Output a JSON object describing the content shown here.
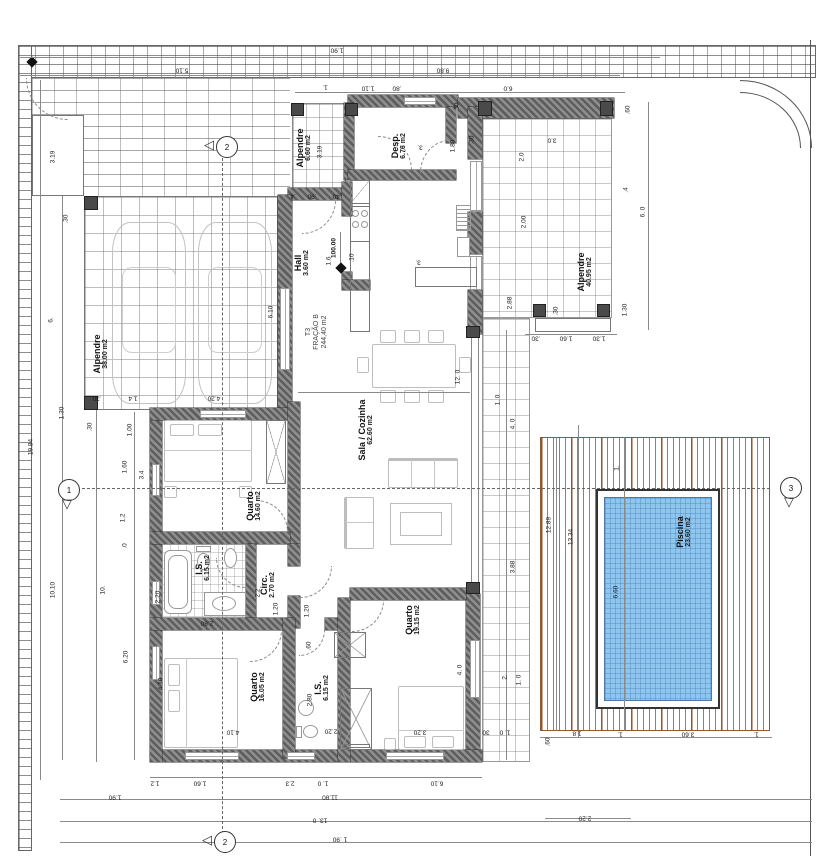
{
  "colors": {
    "wall_hatch": "#5e5e5e",
    "deck_stripe": "#a0522d",
    "pool_water": "#8ec6ee",
    "line": "#555",
    "brick_line": "#5f5f5f"
  },
  "plan": {
    "rooms": [
      {
        "lines": [
          "Alpendre",
          "38.00 m2"
        ],
        "x": 101,
        "y": 354,
        "style": "room"
      },
      {
        "lines": [
          "Alpendre",
          "6.60 m2"
        ],
        "x": 304,
        "y": 148,
        "style": "room"
      },
      {
        "lines": [
          "Hall",
          "3.60 m2"
        ],
        "x": 302,
        "y": 263,
        "style": "room"
      },
      {
        "lines": [
          "Desp.",
          "6.76 m2"
        ],
        "x": 399,
        "y": 146,
        "style": "room"
      },
      {
        "lines": [
          "T3",
          "FRAÇÃO B",
          "244,40 m2"
        ],
        "x": 317,
        "y": 332,
        "style": "unit"
      },
      {
        "lines": [
          "Sala / Cozinha",
          "62.60 m2"
        ],
        "x": 366,
        "y": 430,
        "style": "room"
      },
      {
        "lines": [
          "Quarto",
          "14.60 m2"
        ],
        "x": 254,
        "y": 506,
        "style": "room"
      },
      {
        "lines": [
          "I.S.",
          "6.15 m2"
        ],
        "x": 203,
        "y": 568,
        "style": "room"
      },
      {
        "lines": [
          "Circ.",
          "2.70 m2"
        ],
        "x": 268,
        "y": 585,
        "style": "room"
      },
      {
        "lines": [
          "Quarto",
          "16.05 m2"
        ],
        "x": 258,
        "y": 687,
        "style": "room"
      },
      {
        "lines": [
          "I.S.",
          "6.15 m2"
        ],
        "x": 322,
        "y": 688,
        "style": "room"
      },
      {
        "lines": [
          "Quarto",
          "19.15 m2"
        ],
        "x": 413,
        "y": 620,
        "style": "room"
      },
      {
        "lines": [
          "Alpendre",
          "40.95 m2"
        ],
        "x": 585,
        "y": 272,
        "style": "room"
      },
      {
        "lines": [
          "Piscina",
          "23.60 m2"
        ],
        "x": 684,
        "y": 532,
        "style": "room"
      }
    ],
    "dims": [
      {
        "t": "1.90",
        "x": 337,
        "y": 50,
        "r": 180
      },
      {
        "t": "5.10",
        "x": 182,
        "y": 70,
        "r": 180
      },
      {
        "t": "9.80",
        "x": 443,
        "y": 70,
        "r": 180
      },
      {
        "t": "6.0",
        "x": 508,
        "y": 88,
        "r": 180
      },
      {
        "t": "1.",
        "x": 325,
        "y": 87,
        "r": 180
      },
      {
        "t": "1.10",
        "x": 368,
        "y": 88,
        "r": 180
      },
      {
        "t": ".80",
        "x": 397,
        "y": 88,
        "r": 180
      },
      {
        "t": ".4",
        "x": 293,
        "y": 196,
        "r": 180
      },
      {
        "t": ".90",
        "x": 312,
        "y": 196,
        "r": 180
      },
      {
        "t": ".40",
        "x": 337,
        "y": 196,
        "r": 180
      },
      {
        "t": "3.0",
        "x": 552,
        "y": 140,
        "r": 180
      },
      {
        "t": "3.",
        "x": 420,
        "y": 147,
        "r": 180
      },
      {
        "t": "3.",
        "x": 418,
        "y": 262,
        "r": 180
      },
      {
        "t": ".60",
        "x": 628,
        "y": 110,
        "r": -90
      },
      {
        "t": ".30",
        "x": 457,
        "y": 107,
        "r": -90
      },
      {
        "t": ".30",
        "x": 472,
        "y": 140,
        "r": -90
      },
      {
        "t": "1.80",
        "x": 453,
        "y": 146,
        "r": -90
      },
      {
        "t": "2.0",
        "x": 522,
        "y": 157,
        "r": -90
      },
      {
        "t": "2.00",
        "x": 524,
        "y": 222,
        "r": -90
      },
      {
        "t": "2.88",
        "x": 510,
        "y": 303,
        "r": -90
      },
      {
        "t": ".4",
        "x": 626,
        "y": 190,
        "r": -90
      },
      {
        "t": "6. 0",
        "x": 643,
        "y": 212,
        "r": -90
      },
      {
        "t": "1.30",
        "x": 625,
        "y": 310,
        "r": -90
      },
      {
        "t": ".30",
        "x": 556,
        "y": 311,
        "r": -90
      },
      {
        "t": ".30",
        "x": 536,
        "y": 338,
        "r": 180
      },
      {
        "t": "1.60",
        "x": 566,
        "y": 338,
        "r": 180
      },
      {
        "t": "1.30",
        "x": 599,
        "y": 338,
        "r": 180
      },
      {
        "t": "19.84",
        "x": 31,
        "y": 447,
        "r": -90
      },
      {
        "t": "3.19",
        "x": 53,
        "y": 157,
        "r": -90
      },
      {
        "t": "6.",
        "x": 51,
        "y": 320,
        "r": -90
      },
      {
        "t": "10.10",
        "x": 53,
        "y": 590,
        "r": -90
      },
      {
        "t": ".30",
        "x": 66,
        "y": 219,
        "r": -90
      },
      {
        "t": "1.30",
        "x": 62,
        "y": 413,
        "r": -90
      },
      {
        "t": ".30",
        "x": 90,
        "y": 427,
        "r": -90
      },
      {
        "t": "1.00",
        "x": 130,
        "y": 430,
        "r": -90
      },
      {
        "t": "1.60",
        "x": 125,
        "y": 467,
        "r": -90
      },
      {
        "t": "10.",
        "x": 103,
        "y": 590,
        "r": -90
      },
      {
        "t": "6.20",
        "x": 126,
        "y": 657,
        "r": -90
      },
      {
        "t": "1.2",
        "x": 123,
        "y": 518,
        "r": -90
      },
      {
        "t": ".0",
        "x": 125,
        "y": 546,
        "r": -90
      },
      {
        "t": "4.20",
        "x": 214,
        "y": 398,
        "r": 180
      },
      {
        "t": "1.4",
        "x": 133,
        "y": 398,
        "r": 180
      },
      {
        "t": ".30",
        "x": 97,
        "y": 398,
        "r": 180
      },
      {
        "t": "6.10",
        "x": 271,
        "y": 312,
        "r": -90
      },
      {
        "t": "3.19",
        "x": 320,
        "y": 152,
        "r": -90
      },
      {
        "t": "1.6",
        "x": 329,
        "y": 261,
        "r": -90
      },
      {
        "t": ".10",
        "x": 352,
        "y": 258,
        "r": -90
      },
      {
        "t": "3.4",
        "x": 142,
        "y": 475,
        "r": -90
      },
      {
        "t": "2.20",
        "x": 158,
        "y": 597,
        "r": -90
      },
      {
        "t": "2.2",
        "x": 258,
        "y": 593,
        "r": -90
      },
      {
        "t": "2.80",
        "x": 207,
        "y": 623,
        "r": 180
      },
      {
        "t": "1.20",
        "x": 276,
        "y": 609,
        "r": -90
      },
      {
        "t": "1.20",
        "x": 307,
        "y": 611,
        "r": -90
      },
      {
        "t": ".60",
        "x": 309,
        "y": 646,
        "r": -90
      },
      {
        "t": "2.80",
        "x": 310,
        "y": 700,
        "r": -90
      },
      {
        "t": "2.20",
        "x": 331,
        "y": 731,
        "r": 180
      },
      {
        "t": "4.10",
        "x": 161,
        "y": 684,
        "r": -90
      },
      {
        "t": "4.10",
        "x": 233,
        "y": 732,
        "r": 180
      },
      {
        "t": "3.20",
        "x": 420,
        "y": 732,
        "r": 180
      },
      {
        "t": "4. 0",
        "x": 460,
        "y": 670,
        "r": -90
      },
      {
        "t": "12. 0",
        "x": 458,
        "y": 377,
        "r": -90
      },
      {
        "t": "1. 0",
        "x": 498,
        "y": 400,
        "r": -90
      },
      {
        "t": "4. 0",
        "x": 513,
        "y": 424,
        "r": -90
      },
      {
        "t": "3.88",
        "x": 513,
        "y": 567,
        "r": -90
      },
      {
        "t": "2.",
        "x": 505,
        "y": 677,
        "r": -90
      },
      {
        "t": "1. 0",
        "x": 519,
        "y": 680,
        "r": -90
      },
      {
        "t": "12.89",
        "x": 549,
        "y": 525,
        "r": -90
      },
      {
        "t": "13.34",
        "x": 571,
        "y": 537,
        "r": -90
      },
      {
        "t": "6.60",
        "x": 616,
        "y": 592,
        "r": -90
      },
      {
        "t": "1.",
        "x": 617,
        "y": 468,
        "r": -90
      },
      {
        "t": "30",
        "x": 486,
        "y": 732,
        "r": 180
      },
      {
        "t": "1. 0",
        "x": 505,
        "y": 732,
        "r": 180
      },
      {
        "t": ".60",
        "x": 548,
        "y": 742,
        "r": -90
      },
      {
        "t": "1.8",
        "x": 577,
        "y": 733,
        "r": 180
      },
      {
        "t": "1.",
        "x": 620,
        "y": 734,
        "r": 180
      },
      {
        "t": "3.60",
        "x": 688,
        "y": 734,
        "r": 180
      },
      {
        "t": "1.",
        "x": 756,
        "y": 734,
        "r": 180
      },
      {
        "t": "2.20",
        "x": 585,
        "y": 818,
        "r": 180
      },
      {
        "t": "1.2",
        "x": 155,
        "y": 783,
        "r": 180
      },
      {
        "t": "1.60",
        "x": 200,
        "y": 783,
        "r": 180
      },
      {
        "t": "2.3",
        "x": 290,
        "y": 783,
        "r": 180
      },
      {
        "t": "1. 0",
        "x": 323,
        "y": 783,
        "r": 180
      },
      {
        "t": "6.10",
        "x": 437,
        "y": 783,
        "r": 180
      },
      {
        "t": "1.90",
        "x": 115,
        "y": 797,
        "r": 180
      },
      {
        "t": "11.80",
        "x": 330,
        "y": 797,
        "r": 180
      },
      {
        "t": "13. 0",
        "x": 320,
        "y": 820,
        "r": 180
      },
      {
        "t": "1 .90",
        "x": 340,
        "y": 839,
        "r": 180
      }
    ],
    "markers": [
      {
        "label": "1",
        "x": 68,
        "y": 489,
        "dir": "down"
      },
      {
        "label": "3",
        "x": 790,
        "y": 487,
        "dir": "down"
      },
      {
        "label": "2",
        "x": 226,
        "y": 146,
        "dir": "left"
      },
      {
        "label": "2",
        "x": 224,
        "y": 841,
        "dir": "left"
      }
    ],
    "level": {
      "value": "100.00",
      "x": 341,
      "y": 268
    }
  }
}
